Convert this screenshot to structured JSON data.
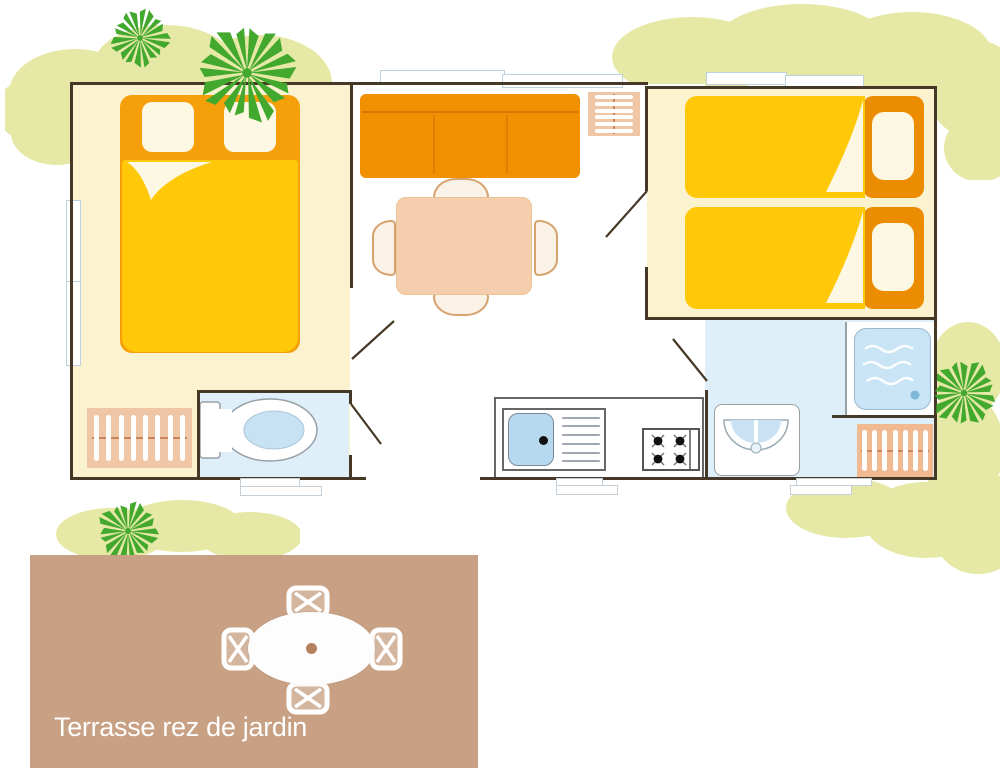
{
  "terrace": {
    "label": "Terrasse rez de jardin"
  },
  "colors": {
    "wall": "#463826",
    "bedroom-floor": "#FBF3D0",
    "living-floor": "#FFFFFF",
    "wet-floor": "#DFEFFA",
    "blanket": "#FFC808",
    "bed-orange": "#F5A00A",
    "bed-orange-deep": "#EC8C00",
    "sofa": "#F19000",
    "pillow": "#FDF8E3",
    "wood": "#EFC6A6",
    "salmon": "#F1B990",
    "table": "#F5CFAD",
    "chair-line": "#D8A26E",
    "chair-fill": "#FBF2E7",
    "sink": "#B7D9EF",
    "shower": "#C8E4F5",
    "basin": "#C9E2F4",
    "toilet-water": "#C7E2F3",
    "drain-blue": "#7FB7D6",
    "terrace": "#C8A083",
    "terrace-text": "#FFFFFF",
    "bush": "#E6E8A6",
    "tree": "#43A92E",
    "window-frame": "#BDD2DE",
    "fixture": "#98A0A6",
    "step-line": "#C4CFD8",
    "rod": "#C9865C",
    "counter-line": "#666666"
  }
}
